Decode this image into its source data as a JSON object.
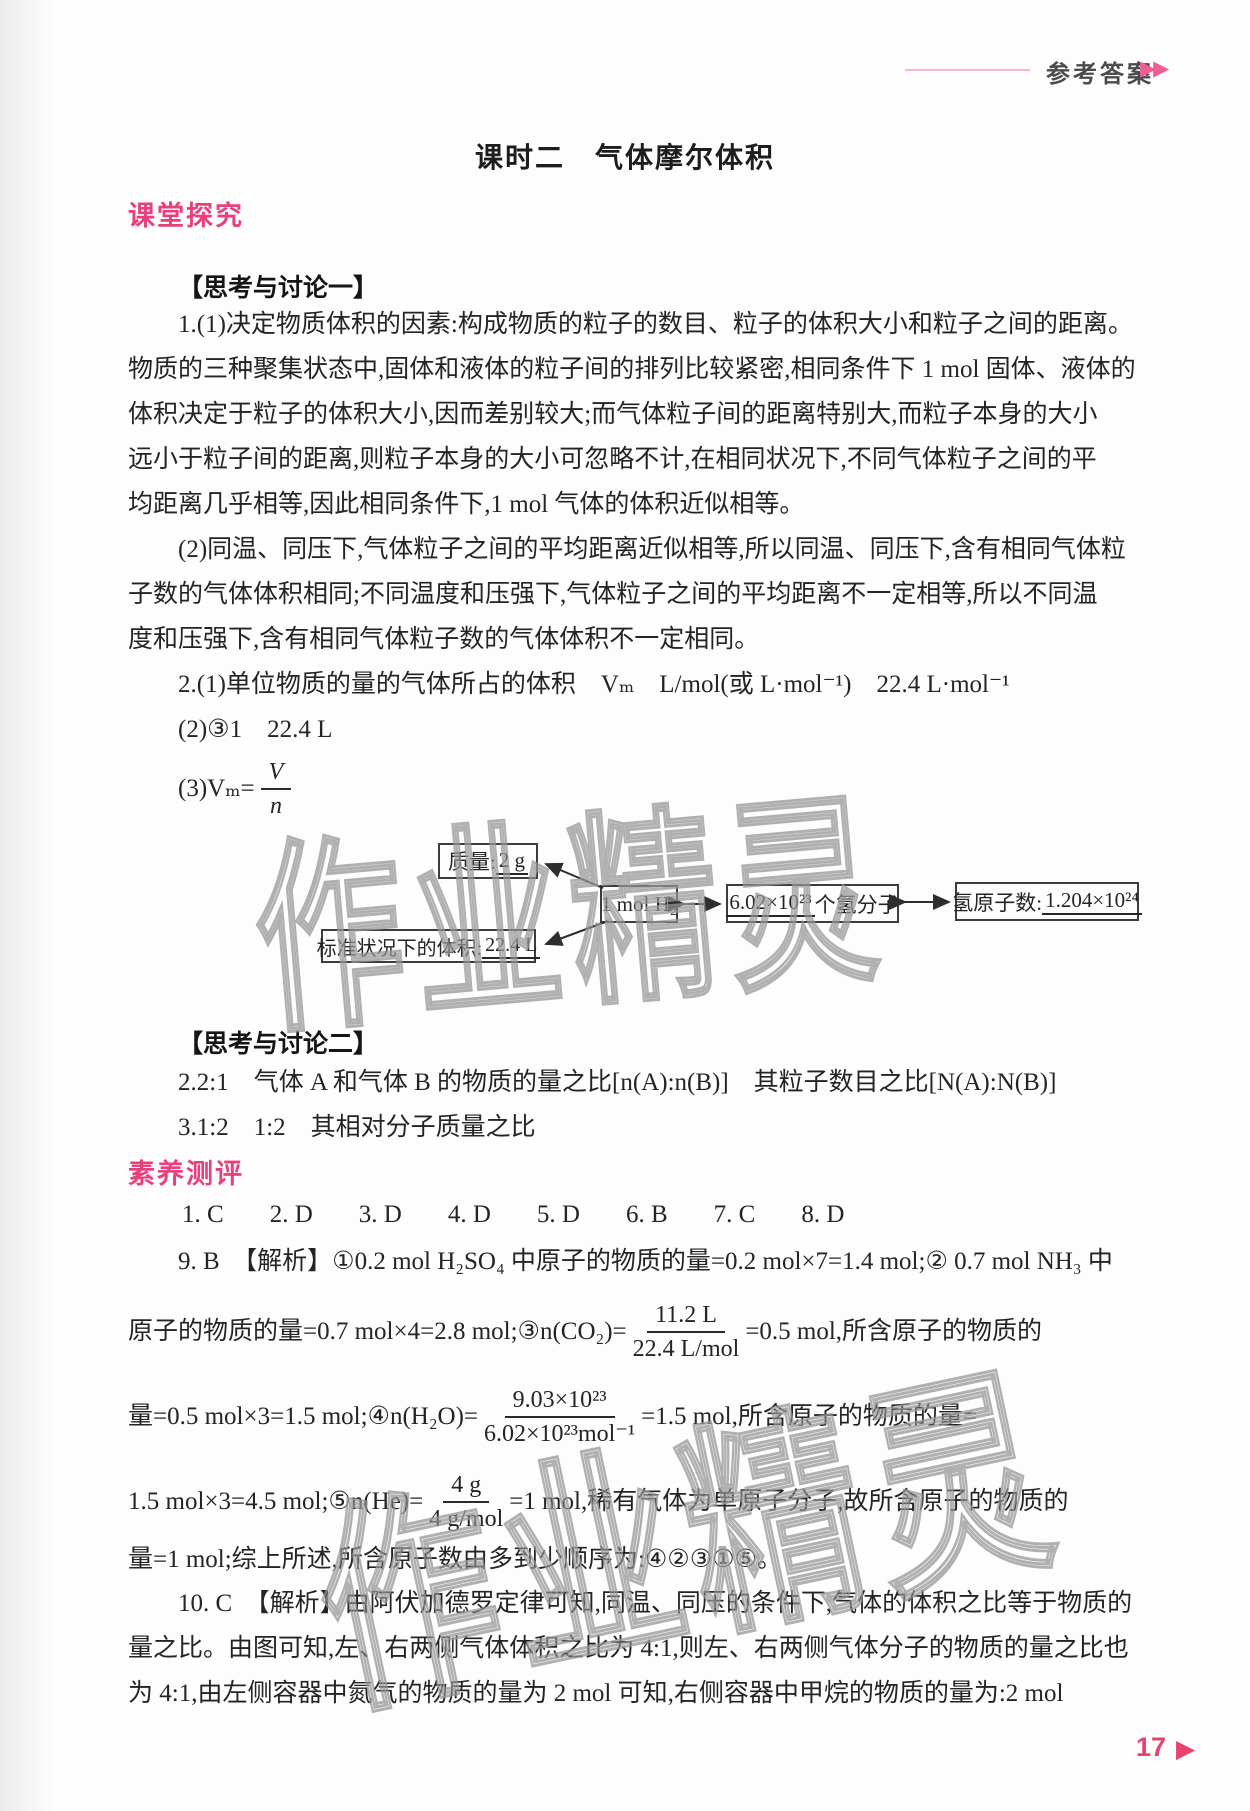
{
  "accent": {
    "pink": "#e8407f",
    "page_pink": "#e5446f"
  },
  "header": {
    "label": "参考答案",
    "arrows": "▶▶"
  },
  "title": "课时二　气体摩尔体积",
  "explore": {
    "heading": "课堂探究",
    "think1": "【思考与讨论一】",
    "p1_lines": [
      "1.(1)决定物质体积的因素:构成物质的粒子的数目、粒子的体积大小和粒子之间的距离。",
      "物质的三种聚集状态中,固体和液体的粒子间的排列比较紧密,相同条件下 1 mol 固体、液体的",
      "体积决定于粒子的体积大小,因而差别较大;而气体粒子间的距离特别大,而粒子本身的大小",
      "远小于粒子间的距离,则粒子本身的大小可忽略不计,在相同状况下,不同气体粒子之间的平",
      "均距离几乎相等,因此相同条件下,1 mol 气体的体积近似相等。"
    ],
    "p2_lines": [
      "(2)同温、同压下,气体粒子之间的平均距离近似相等,所以同温、同压下,含有相同气体粒",
      "子数的气体体积相同;不同温度和压强下,气体粒子之间的平均距离不一定相等,所以不同温",
      "度和压强下,含有相同气体粒子数的气体体积不一定相同。"
    ],
    "q2_line1": "2.(1)单位物质的量的气体所占的体积　Vₘ　L/mol(或 L·mol⁻¹)　22.4 L·mol⁻¹",
    "q2_line2": "(2)③1　22.4 L",
    "q2_line3_pre": "(3)Vₘ=",
    "q2_frac": {
      "num": "V",
      "den": "n"
    },
    "diagram": {
      "mass_label": "质量: ",
      "mass_value": "2 g",
      "center": "1 mol H₂",
      "molecules_value": "6.02×10²³",
      "molecules_suffix": "个氢分子",
      "atoms_label": "氢原子数:",
      "atoms_value": "1.204×10²⁴",
      "volume_label": "标准状况下的体积: ",
      "volume_value": "22.4 L"
    },
    "think2": "【思考与讨论二】",
    "think2_lines": [
      "2.2:1　气体 A 和气体 B 的物质的量之比[n(A):n(B)]　其粒子数目之比[N(A):N(B)]",
      "3.1:2　1:2　其相对分子质量之比"
    ]
  },
  "assess": {
    "heading": "素养测评",
    "choices": [
      "1. C",
      "2. D",
      "3. D",
      "4. D",
      "5. D",
      "6. B",
      "7. C",
      "8. D"
    ],
    "q9": {
      "line1": "9. B　【解析】①0.2 mol H₂SO₄ 中原子的物质的量=0.2 mol×7=1.4 mol;② 0.7 mol NH₃ 中",
      "lineA": {
        "pre": "原子的物质的量=0.7 mol×4=2.8 mol;③n(CO₂)=",
        "num": "11.2 L",
        "den": "22.4 L/mol",
        "post": "=0.5 mol,所含原子的物质的"
      },
      "lineB": {
        "pre": "量=0.5 mol×3=1.5 mol;④n(H₂O)=",
        "num": "9.03×10²³",
        "den": "6.02×10²³mol⁻¹",
        "post": "=1.5 mol,所含原子的物质的量="
      },
      "lineC": {
        "pre": "1.5 mol×3=4.5 mol;⑤n(He)=",
        "num": "4 g",
        "den": "4 g/mol",
        "post": "=1 mol,稀有气体为单原子分子,故所含原子的物质的"
      },
      "lineD": "量=1 mol;综上所述,所含原子数由多到少顺序为:④②③①⑤。"
    },
    "q10_lines": [
      "10. C　【解析】由阿伏加德罗定律可知,同温、同压的条件下,气体的体积之比等于物质的",
      "量之比。由图可知,左、右两侧气体体积之比为 4:1,则左、右两侧气体分子的物质的量之比也",
      "为 4:1,由左侧容器中氮气的物质的量为 2 mol 可知,右侧容器中甲烷的物质的量为:2 mol"
    ]
  },
  "watermark": "作业精灵",
  "footer": {
    "page": "17",
    "arrow": "▶"
  }
}
